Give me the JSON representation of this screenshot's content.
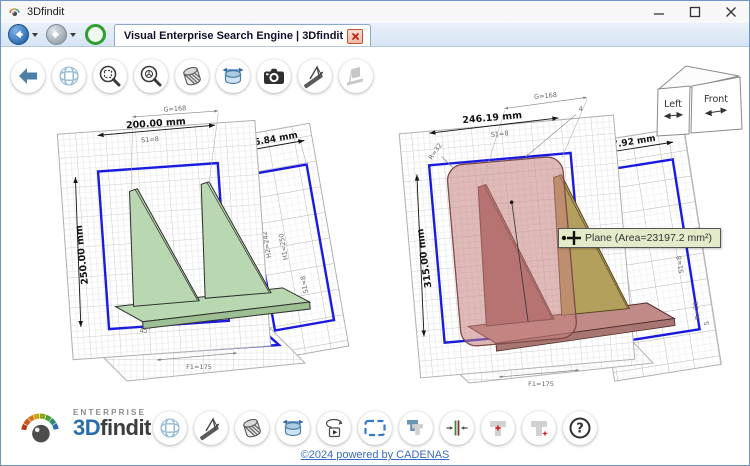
{
  "window": {
    "title": "3Dfindit"
  },
  "tab": {
    "title": "Visual Enterprise Search Engine | 3Dfindit"
  },
  "nav": {
    "buttons": [
      "back",
      "back-history",
      "forward",
      "forward-history",
      "reload"
    ]
  },
  "top_toolbar": {
    "buttons": [
      "back",
      "wireframe-mesh",
      "zoom-fit",
      "zoom-select",
      "section-view",
      "measure-diameter",
      "screenshot",
      "measure-angle",
      "measure-feature-disabled"
    ]
  },
  "viewer": {
    "left_model": {
      "part_color": "#b9d7b0",
      "dims": {
        "g": "G=168",
        "width": "200.00 mm",
        "s1_top": "S1=8",
        "depth": "196.84 mm",
        "height": "250.00 mm",
        "h2": "H2=242",
        "h1": "H1=250",
        "s1_side": "S1=8",
        "angle": "45°",
        "f1": "F1=175"
      }
    },
    "right_model": {
      "part_color": "#c5827f",
      "dims": {
        "g": "G=168",
        "width": "246.19 mm",
        "s1_top": "S1=8",
        "depth": "197.92 mm",
        "r_top": "R=32",
        "leader": "4",
        "height": "315.00 mm",
        "s1_side": "S1=8",
        "r_side": "R=32",
        "r5": "5",
        "f1": "F1=175"
      },
      "tooltip": "Plane (Area=23197.2 mm²)"
    },
    "view_cube": {
      "left": "Left",
      "front": "Front"
    }
  },
  "bottom_toolbar": {
    "buttons": [
      "wireframe-mesh",
      "measure-angle",
      "section-view",
      "measure-diameter",
      "animate-rotate",
      "zoom-frame",
      "compare-parts",
      "align-parts",
      "part-origin-center",
      "part-origin-corner",
      "help"
    ],
    "help_glyph": "?"
  },
  "footer": {
    "enterprise": "ENTERPRISE",
    "brand_3d": "3D",
    "brand_findit": "findit",
    "copyright": "©2024 powered by CADENAS"
  },
  "colors": {
    "outline_blue": "#1b1be0",
    "part_green": "#b9d7b0",
    "part_red_highlight": "#c5827f",
    "tooltip_bg": "#e4ebca",
    "link_blue": "#3b6cc4",
    "brand_blue": "#2a6fad"
  }
}
